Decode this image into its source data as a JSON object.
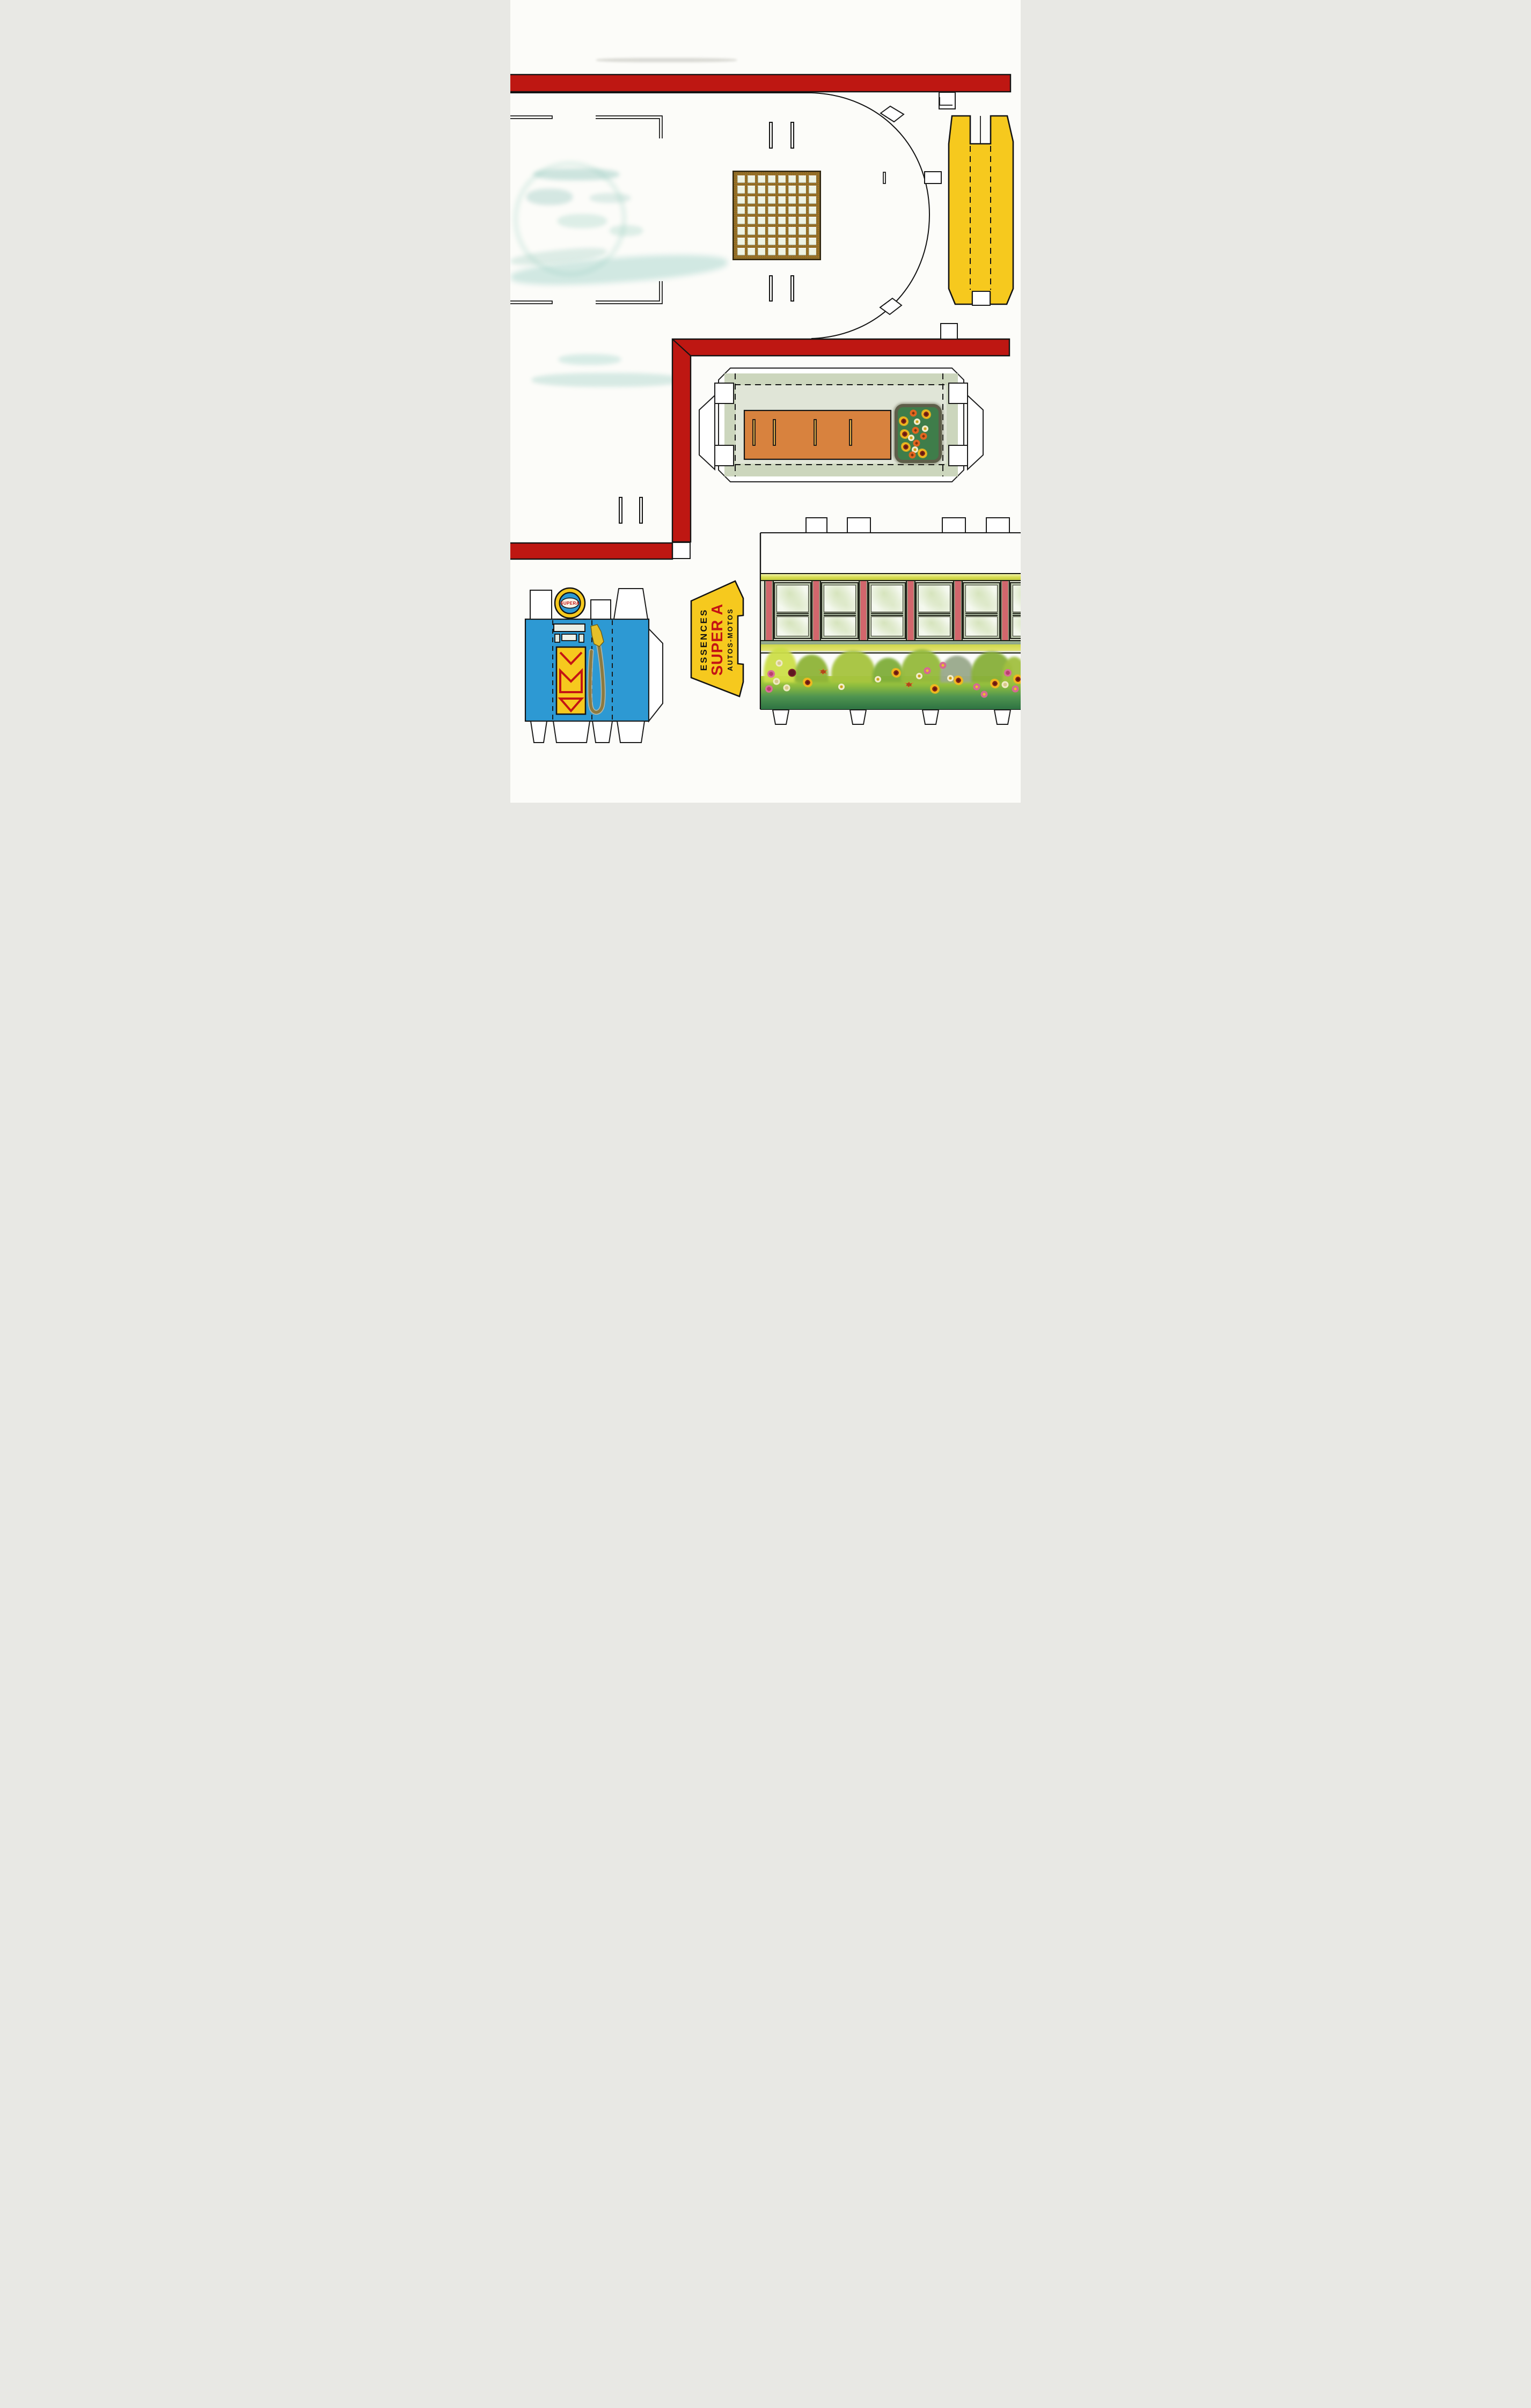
{
  "document": {
    "kind": "Vintage paper-model cut-out sheet (scan)",
    "subject": "Service-station model: canopy base, pillar, planter, shop wall, gas pump, sign"
  },
  "colors": {
    "paper": "#fcfcf9",
    "red_band": "#be1712",
    "yellow": "#f6c91e",
    "pump_blue": "#2d99d3",
    "grid_brown": "#8e6e26",
    "grid_pane": "#eef3e3",
    "planter_sage": "#ccd6bd",
    "planter_sage_light": "#e0e5d7",
    "planter_orange": "#d8823e",
    "window_pillar_pink": "#d2666c",
    "window_frame_sage": "#b9c3ab",
    "glass": "#f4f8ee",
    "garden_green_light": "#b5d23f",
    "garden_green_dark": "#2e7342",
    "sign_red": "#c41414"
  },
  "sign": {
    "line_top": "ESSENCES",
    "line_middle": "SUPER A",
    "line_bottom": "AUTOS-MOTOS"
  },
  "pump": {
    "globe_text": "SUPERA"
  },
  "skylight": {
    "rows": 8,
    "cols": 8
  },
  "window_band": {
    "units": 6
  },
  "planter_flowers": [
    {
      "t": "zinnia",
      "x": 38,
      "y": 11
    },
    {
      "t": "marigold",
      "x": 70,
      "y": 13
    },
    {
      "t": "marigold",
      "x": 15,
      "y": 27
    },
    {
      "t": "daisy",
      "x": 47,
      "y": 28
    },
    {
      "t": "daisy",
      "x": 67,
      "y": 41
    },
    {
      "t": "zinnia",
      "x": 43,
      "y": 44
    },
    {
      "t": "marigold",
      "x": 17,
      "y": 51
    },
    {
      "t": "zinnia",
      "x": 63,
      "y": 55
    },
    {
      "t": "daisy",
      "x": 33,
      "y": 58
    },
    {
      "t": "zinnia",
      "x": 46,
      "y": 68
    },
    {
      "t": "marigold",
      "x": 20,
      "y": 75
    },
    {
      "t": "daisy",
      "x": 42,
      "y": 81
    },
    {
      "t": "zinnia",
      "x": 36,
      "y": 91
    },
    {
      "t": "marigold",
      "x": 61,
      "y": 88
    }
  ],
  "garden_flowers": [
    {
      "t": "rose_cream",
      "x": 7,
      "y": 14
    },
    {
      "t": "rose_pink",
      "x": 4,
      "y": 34
    },
    {
      "t": "rose_dark",
      "x": 12,
      "y": 32
    },
    {
      "t": "rose_cream",
      "x": 6,
      "y": 48
    },
    {
      "t": "rose_pink",
      "x": 3,
      "y": 62
    },
    {
      "t": "rose_cream",
      "x": 10,
      "y": 60
    },
    {
      "t": "marigold",
      "x": 18,
      "y": 50
    },
    {
      "t": "spiky",
      "x": 24,
      "y": 30
    },
    {
      "t": "daisy",
      "x": 31,
      "y": 58
    },
    {
      "t": "daisy",
      "x": 45,
      "y": 44
    },
    {
      "t": "marigold",
      "x": 52,
      "y": 32
    },
    {
      "t": "spiky",
      "x": 57,
      "y": 54
    },
    {
      "t": "daisy",
      "x": 61,
      "y": 38
    },
    {
      "t": "poppy",
      "x": 64,
      "y": 28
    },
    {
      "t": "marigold",
      "x": 67,
      "y": 62
    },
    {
      "t": "poppy",
      "x": 70,
      "y": 18
    },
    {
      "t": "daisy",
      "x": 73,
      "y": 42
    },
    {
      "t": "marigold",
      "x": 76,
      "y": 46
    },
    {
      "t": "poppy",
      "x": 83,
      "y": 58
    },
    {
      "t": "poppy",
      "x": 86,
      "y": 72
    },
    {
      "t": "marigold",
      "x": 90,
      "y": 52
    },
    {
      "t": "rose_pink",
      "x": 95,
      "y": 32
    },
    {
      "t": "rose_cream",
      "x": 94,
      "y": 54
    },
    {
      "t": "poppy",
      "x": 98,
      "y": 62
    },
    {
      "t": "marigold",
      "x": 99,
      "y": 44
    }
  ],
  "garden_bushes": [
    {
      "x": 1,
      "w": 13,
      "h": 66,
      "c": "#cddf49"
    },
    {
      "x": 13,
      "w": 13,
      "h": 52,
      "c": "#8fb438"
    },
    {
      "x": 27,
      "w": 17,
      "h": 60,
      "c": "#a6c43e"
    },
    {
      "x": 43,
      "w": 12,
      "h": 46,
      "c": "#7fae3a"
    },
    {
      "x": 54,
      "w": 16,
      "h": 62,
      "c": "#95ba3c"
    },
    {
      "x": 69,
      "w": 13,
      "h": 50,
      "c": "#9aa98c"
    },
    {
      "x": 81,
      "w": 16,
      "h": 58,
      "c": "#88b03a"
    },
    {
      "x": 93,
      "w": 9,
      "h": 48,
      "c": "#a2c040"
    }
  ]
}
